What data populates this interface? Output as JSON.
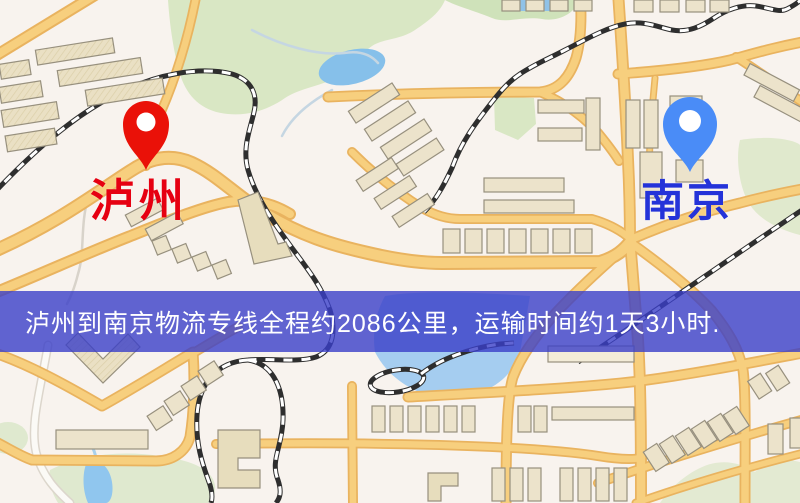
{
  "map": {
    "markers": [
      {
        "id": "origin",
        "label": "泸州",
        "pin_color": "#ea1108",
        "label_color": "#e60011"
      },
      {
        "id": "destination",
        "label": "南京",
        "pin_color": "#4a8cf7",
        "label_color": "#2433d9"
      }
    ],
    "banner": {
      "text": "泸州到南京物流专线全程约2086公里，运输时间约1天3小时.",
      "background_color": "#3a3ec8",
      "text_color": "#ffffff"
    },
    "theme_colors": {
      "map_background": "#f8f3ee",
      "road_fill": "#f7cf7e",
      "road_casing": "#e9b35f",
      "building_fill": "#ece3cb",
      "building_outline": "#97907e",
      "park_green": "#d9e7c4",
      "water_blue": "#8cc3ec",
      "railway_dark": "#2e2e2e"
    }
  }
}
